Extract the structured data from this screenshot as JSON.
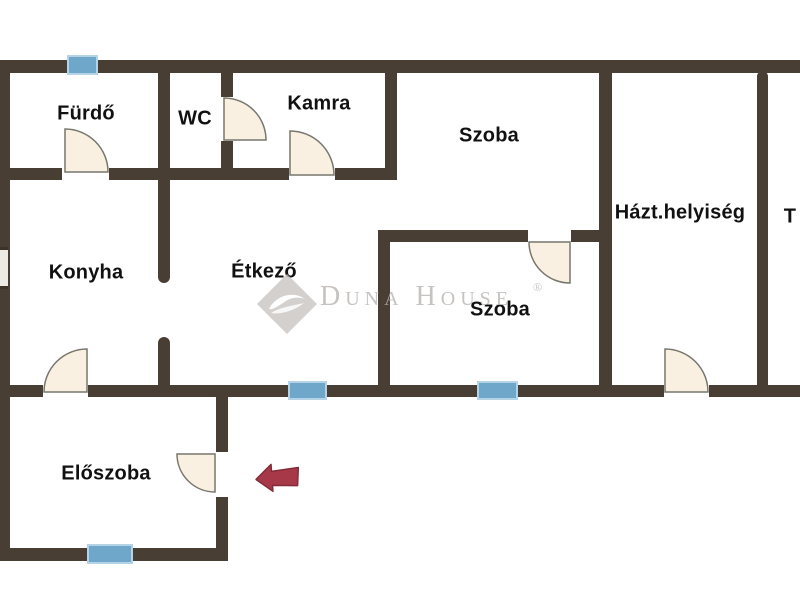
{
  "meta": {
    "type": "floor-plan",
    "language": "hu"
  },
  "rooms": [
    {
      "id": "fuerdo",
      "label": "Fürdő"
    },
    {
      "id": "wc",
      "label": "WC"
    },
    {
      "id": "kamra",
      "label": "Kamra"
    },
    {
      "id": "szoba-felso",
      "label": "Szoba"
    },
    {
      "id": "konyha",
      "label": "Konyha"
    },
    {
      "id": "etkezo",
      "label": "Étkező"
    },
    {
      "id": "hazt-helyiseg",
      "label": "Házt.helyiség"
    },
    {
      "id": "terasz-cut",
      "label": "T"
    },
    {
      "id": "szoba-also",
      "label": "Szoba"
    },
    {
      "id": "eloszoba",
      "label": "Előszoba"
    }
  ],
  "watermark": {
    "brand": "Duna House",
    "registered": "®"
  },
  "icons": {
    "entrance_arrow": "left-block-arrow",
    "door_swing": "quarter-circle-arc",
    "window_marker": "blue-bar",
    "brand_logo": "gray-diamond-with-white-hand"
  },
  "colors": {
    "wall": "#493e33",
    "window": "#6fa7cb",
    "window_border": "#b5d3e7",
    "door_fill": "#faf0e2",
    "door_stroke": "#77776e",
    "arrow": "#a73848",
    "watermark": "#b7b3af",
    "text": "#111111",
    "background": "#ffffff"
  }
}
